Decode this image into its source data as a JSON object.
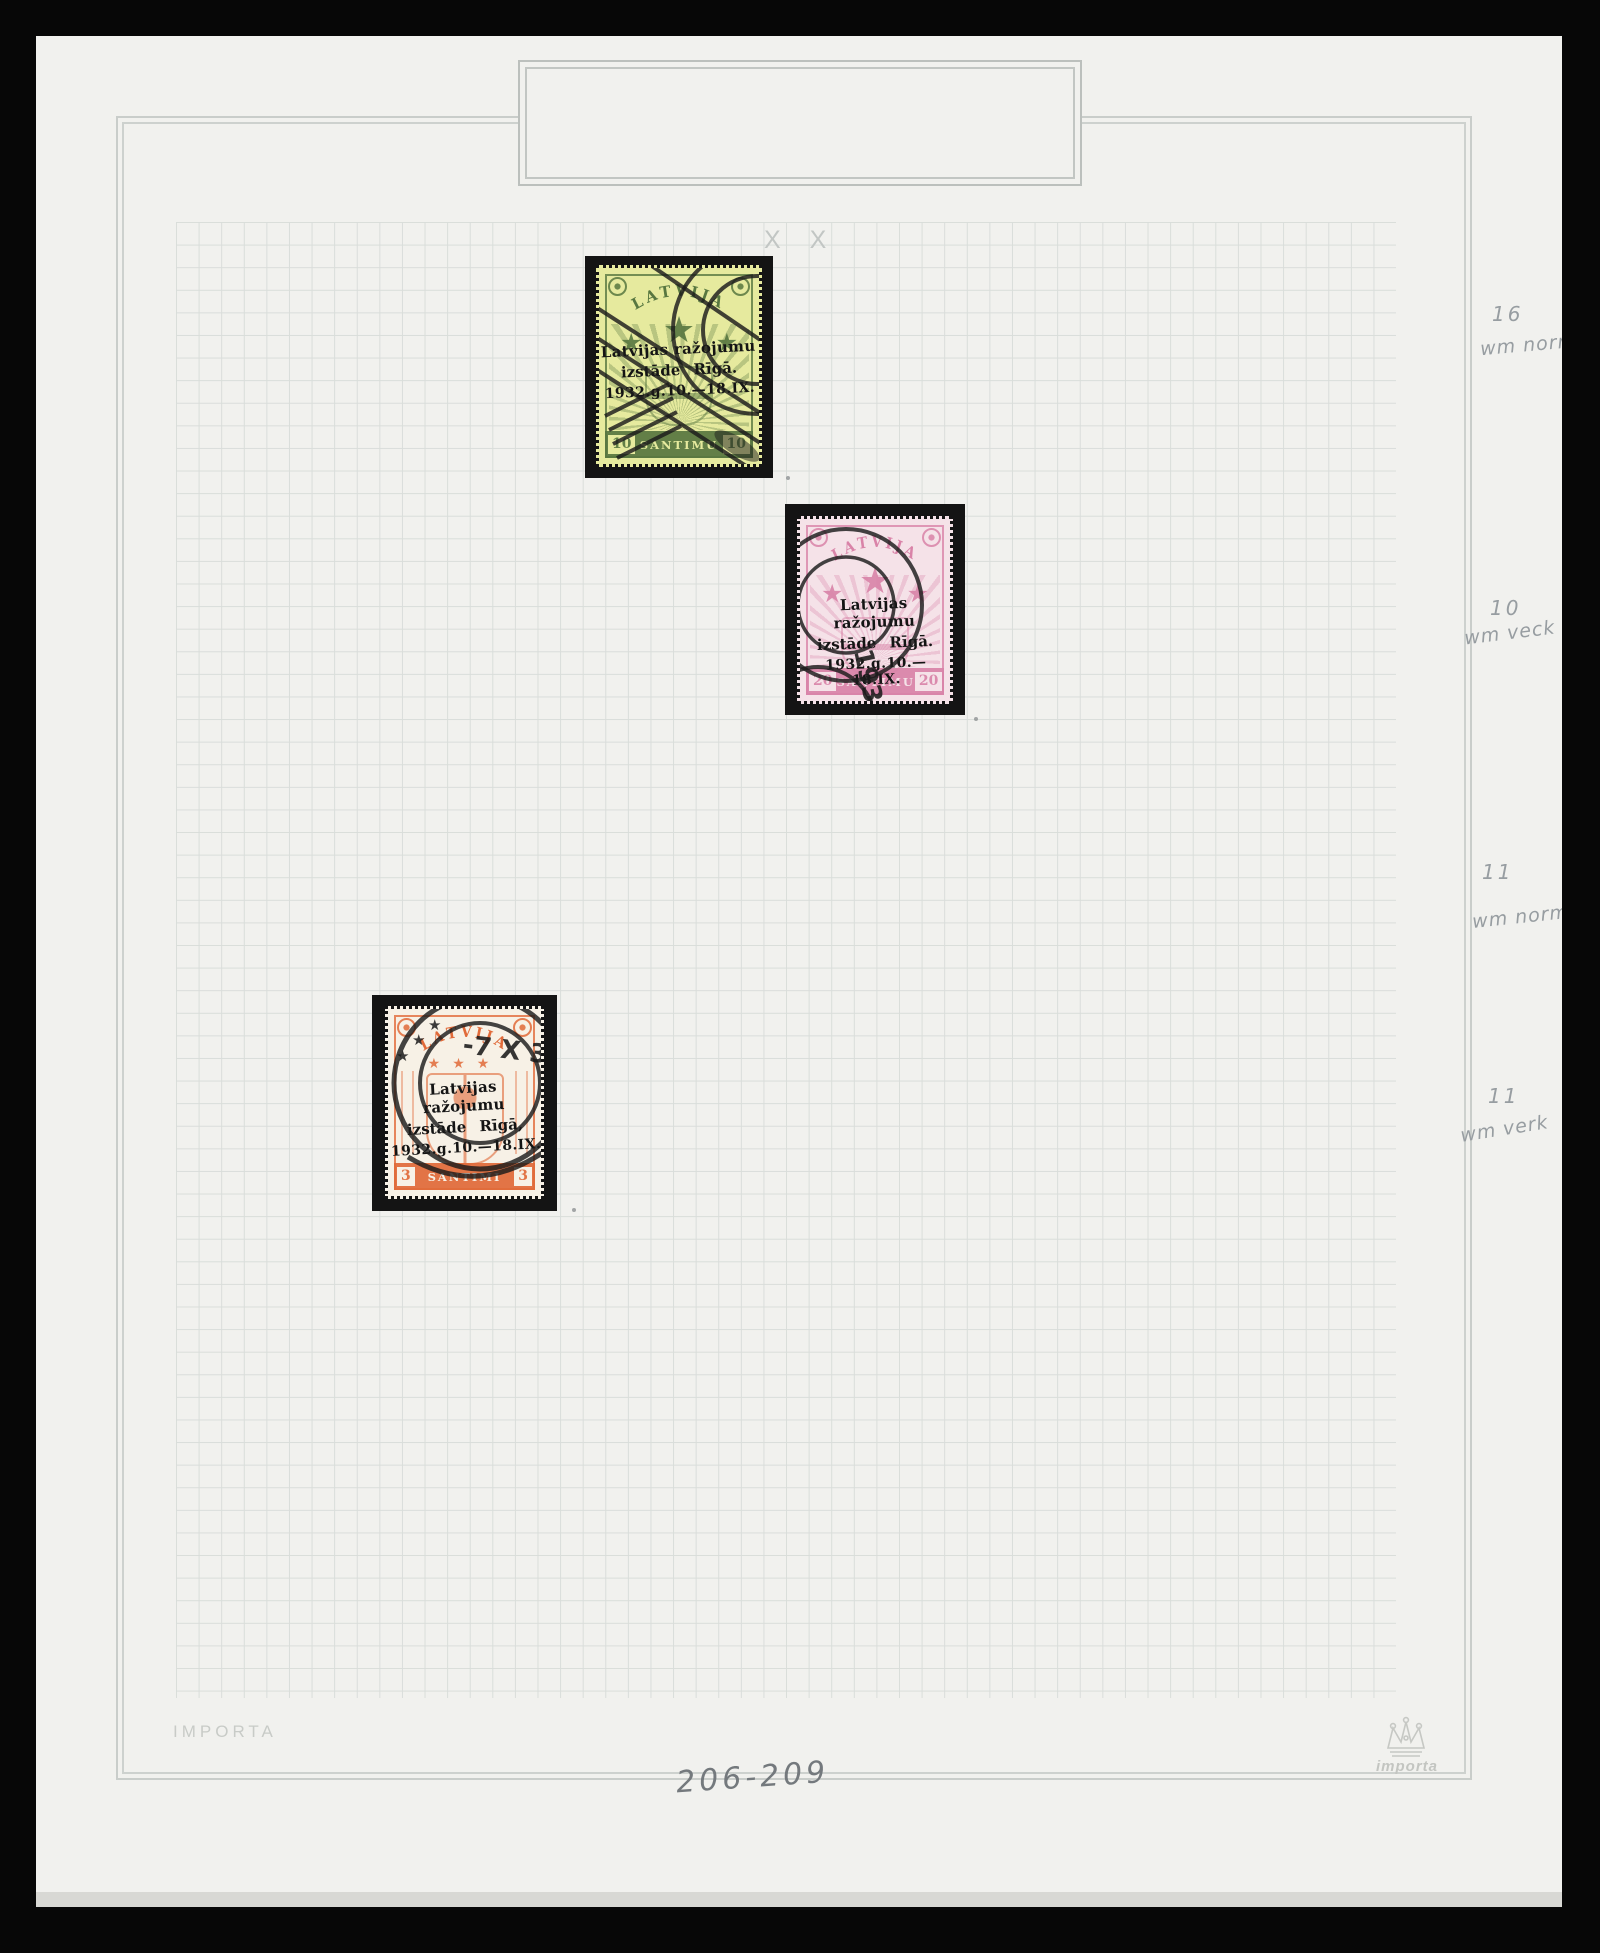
{
  "scan": {
    "grid_mark": "X X",
    "publisher_text": "IMPORTA",
    "logo_text": "importa",
    "page_numbers_note": "206-209",
    "colors": {
      "photo_background": "#070707",
      "album_page": "#f1f1ee",
      "frame_line": "#c9cdca",
      "grid_line": "#d9ddda",
      "stamp_mount": "#141414",
      "pencil_gray": "#979da1",
      "print_gray": "#c8cbc7",
      "postmark_ink": "#1b1b1b"
    }
  },
  "icons": {
    "star": "★"
  },
  "annotations": [
    {
      "line1": "16",
      "line2": "wm norm"
    },
    {
      "line1": "10",
      "line2": "wm veck"
    },
    {
      "line1": "11",
      "line2": "wm norm"
    },
    {
      "line1": "11",
      "line2": "wm verk"
    }
  ],
  "stamps": [
    {
      "country": "LATVIJA",
      "overprint_line1": "Latvijas ražojumu",
      "overprint_line2": "izstāde Rīgā.",
      "overprint_line3": "1932.g.10.—18.IX.",
      "value_left": "10",
      "value_right": "10",
      "denomination": "SANTIMU",
      "paper_color": "#e6ea9e",
      "ink_color": "#587740"
    },
    {
      "country": "LATVIJA",
      "overprint_line1": "Latvijas ražojumu",
      "overprint_line2": "izstāde Rīgā.",
      "overprint_line3": "1932.g.10.—18.IX.",
      "value_left": "20",
      "value_right": "20",
      "denomination": "SANTIMU",
      "paper_color": "#f5e2e8",
      "ink_color": "#d983a8",
      "postmark_text": "1932"
    },
    {
      "country": "LATVIJA",
      "overprint_line1": "Latvijas ražojumu",
      "overprint_line2": "izstāde Rīgā,",
      "overprint_line3": "1932.g.10.—18.IX.",
      "value_left": "3",
      "value_right": "3",
      "denomination": "SANTIMI",
      "paper_color": "#f7f1e6",
      "ink_color": "#e16a39",
      "postmark_text": "-7 X 32"
    }
  ]
}
